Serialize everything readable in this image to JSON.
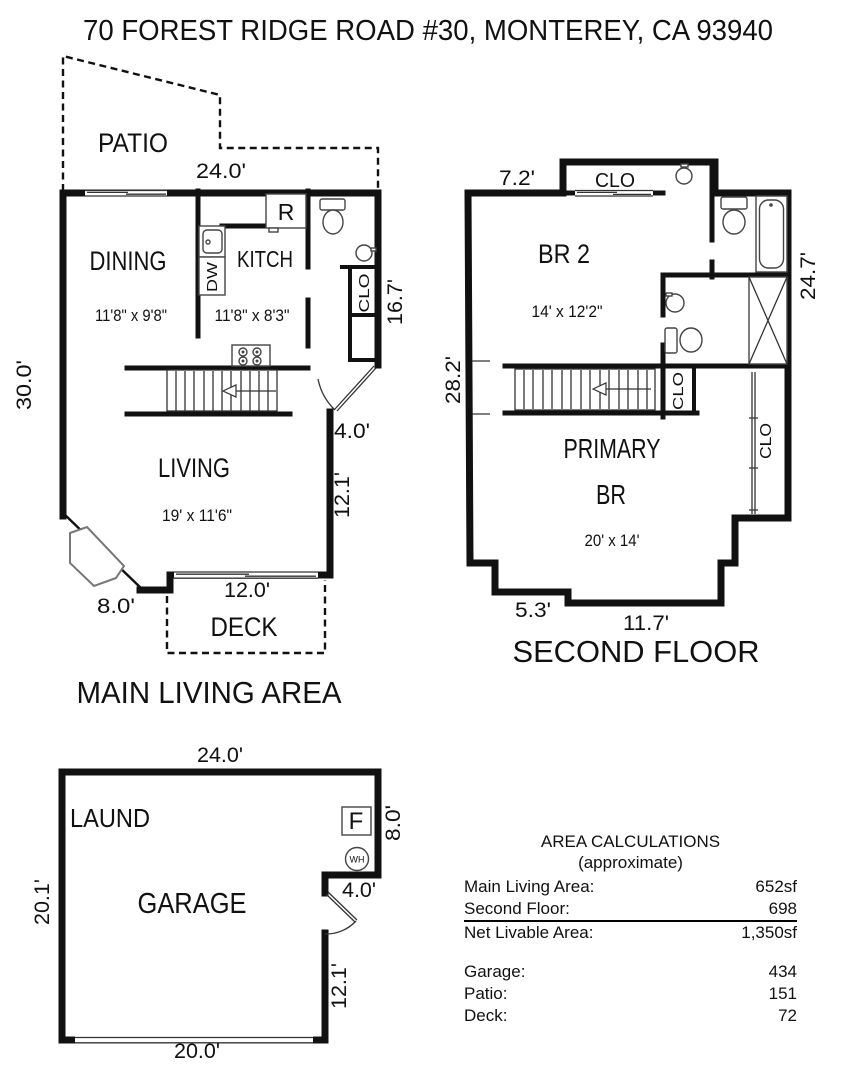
{
  "title": "70 FOREST RIDGE ROAD #30, MONTEREY, CA 93940",
  "main_floor": {
    "caption": "MAIN LIVING AREA",
    "patio_label": "PATIO",
    "deck_label": "DECK",
    "dining_label": "DINING",
    "dining_size": "11'8\" x 9'8\"",
    "kitchen_label": "KITCH",
    "kitchen_size": "11'8\" x 8'3\"",
    "living_label": "LIVING",
    "living_size": "19' x 11'6\"",
    "refrigerator_label": "R",
    "dishwasher_label": "DW",
    "closet_label": "CLO",
    "dim_top": "24.0'",
    "dim_left": "30.0'",
    "dim_right_upper": "16.7'",
    "dim_entry": "4.0'",
    "dim_right_lower": "12.1'",
    "dim_bottom_left": "8.0'",
    "dim_deck": "12.0'"
  },
  "second_floor": {
    "caption": "SECOND FLOOR",
    "br2_label": "BR 2",
    "br2_size": "14' x 12'2\"",
    "primary_label_line1": "PRIMARY",
    "primary_label_line2": "BR",
    "primary_size": "20' x 14'",
    "closet_top_label": "CLO",
    "closet_hall_label": "CLO",
    "closet_primary_label": "CLO",
    "dim_top_left": "7.2'",
    "dim_left": "28.2'",
    "dim_right": "24.7'",
    "dim_bottom_step": "5.3'",
    "dim_bottom": "11.7'"
  },
  "garage": {
    "laundry_label": "LAUND",
    "garage_label": "GARAGE",
    "furnace_label": "F",
    "water_heater_label": "WH",
    "dim_top": "24.0'",
    "dim_left": "20.1'",
    "dim_right_upper": "8.0'",
    "dim_step": "4.0'",
    "dim_right_lower": "12.1'",
    "dim_bottom": "20.0'"
  },
  "area_calculations": {
    "title": "AREA CALCULATIONS",
    "subtitle": "(approximate)",
    "rows": [
      {
        "label": "Main Living Area:",
        "value": "652sf"
      },
      {
        "label": "Second Floor:",
        "value": "698"
      },
      {
        "label": "Net Livable Area:",
        "value": "1,350sf"
      },
      {
        "label": "Garage:",
        "value": "434"
      },
      {
        "label": "Patio:",
        "value": "151"
      },
      {
        "label": "Deck:",
        "value": "72"
      }
    ]
  }
}
